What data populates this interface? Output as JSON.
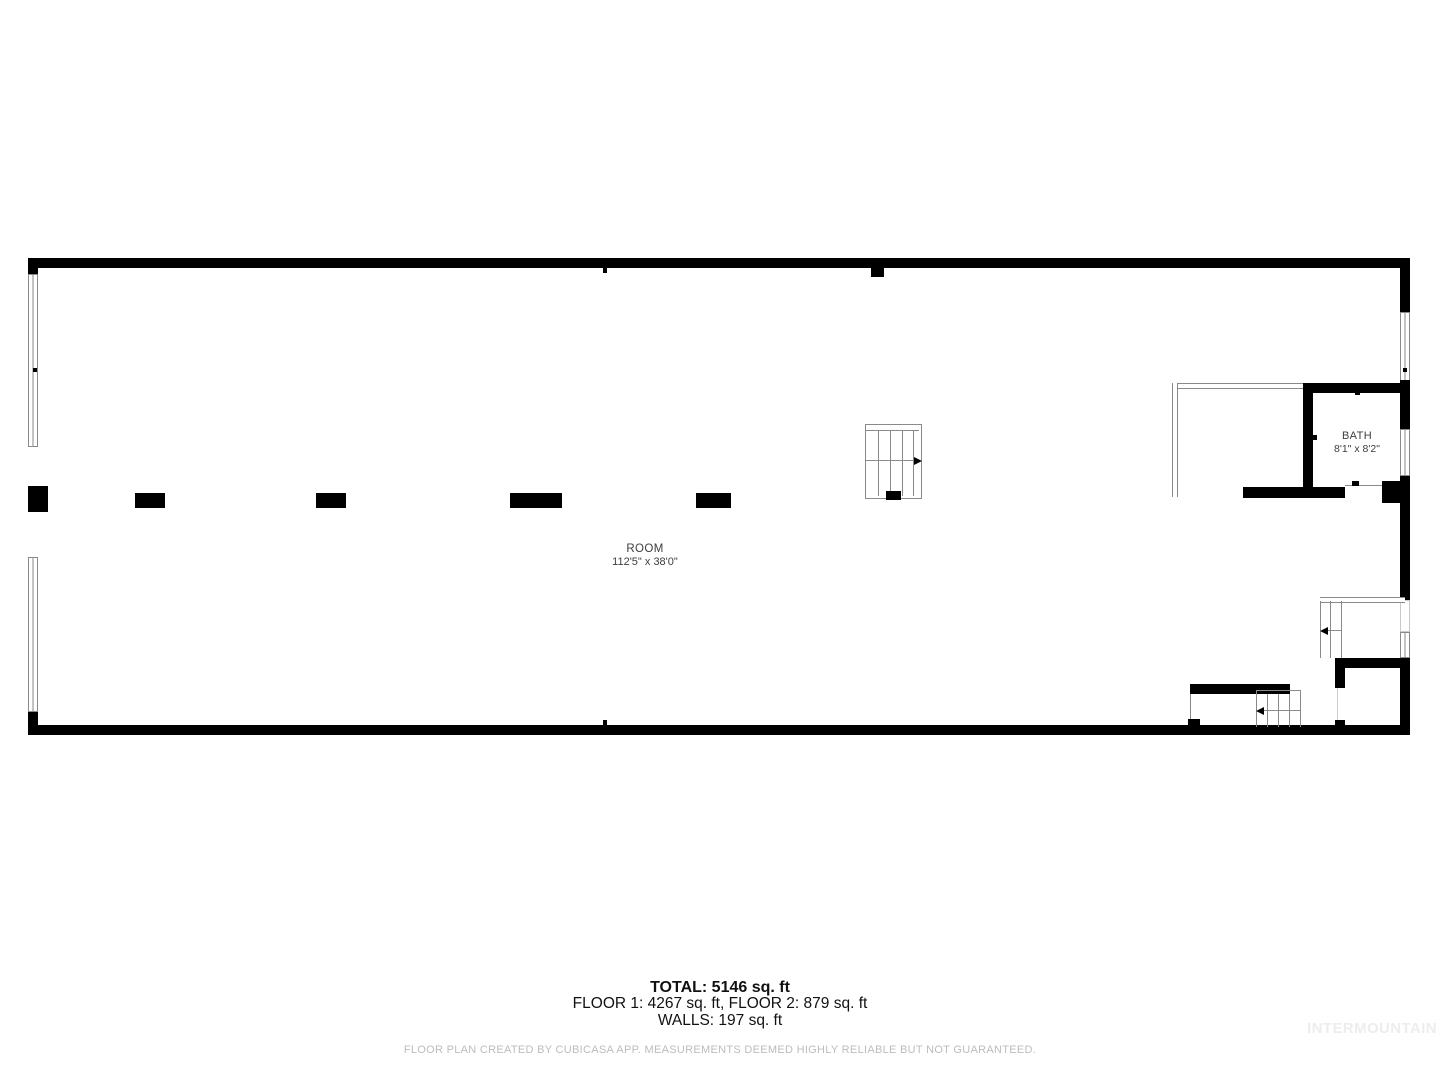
{
  "plan": {
    "room": {
      "name": "ROOM",
      "dims": "112'5\" x 38'0\""
    },
    "bath": {
      "name": "BATH",
      "dims": "8'1\" x 8'2\""
    }
  },
  "summary": {
    "total": "TOTAL: 5146 sq. ft",
    "floors": "FLOOR 1: 4267 sq. ft, FLOOR 2: 879 sq. ft",
    "walls": "WALLS: 197 sq. ft"
  },
  "footer": {
    "disclaimer": "FLOOR PLAN CREATED BY CUBICASA APP. MEASUREMENTS DEEMED HIGHLY RELIABLE BUT NOT GUARANTEED.",
    "watermark": "INTERMOUNTAIN"
  },
  "colors": {
    "wall": "#000000",
    "thin": "#8a8a8a",
    "label": "#3d3d3d",
    "summary": "#111111",
    "disclaimer": "#bcbcbc",
    "watermark": "#ededed"
  }
}
